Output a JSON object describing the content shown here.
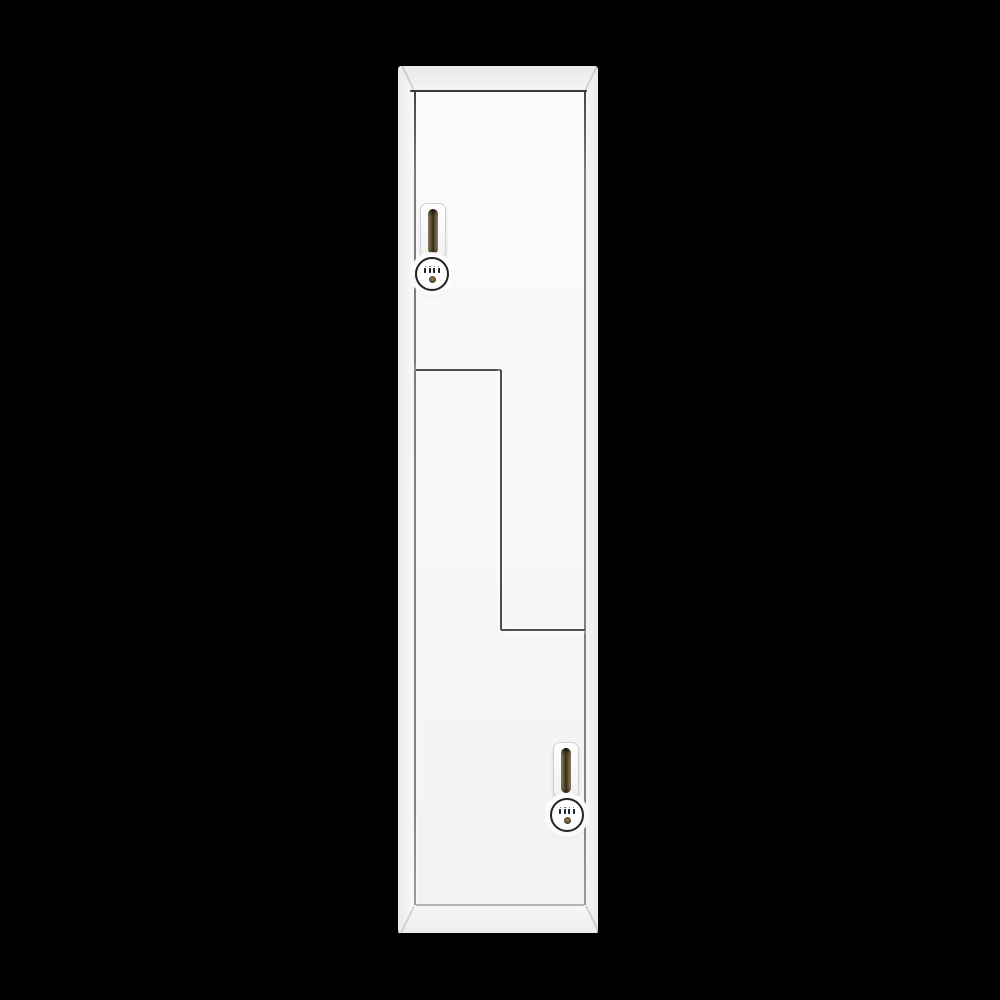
{
  "image": {
    "type": "product-photo",
    "subject": "Tall white Z-style storage locker with two Z-shaped doors, recessed pull handles and round combination locks on a black background",
    "text_content": "none"
  },
  "palette": {
    "background": "#000000",
    "cabinet_white": "#f8f8f8",
    "panel_shadow": "#e9e9e9",
    "seam_dark": "#383838",
    "seam_mid": "#4f4f4f",
    "seam_light": "#b3b3b3",
    "handle_plate": "#fdfdfd",
    "handle_slot_dark": "#332a18",
    "handle_slot_light": "#cdc2a6",
    "lock_ring": "#242424",
    "lock_face": "#ffffff",
    "dial_marks": "#1d2530",
    "keyhole_brass": "#9a7d4e"
  },
  "objects": {
    "cabinet": "locker-cabinet",
    "top_panel": "locker-top-panel",
    "base_panel": "locker-base-panel",
    "upper_door": "upper-z-door",
    "lower_door": "lower-z-door",
    "upper_handle": "upper-door-handle",
    "lower_handle": "lower-door-handle",
    "upper_lock": "upper-door-combination-lock",
    "lower_lock": "lower-door-combination-lock",
    "lock_detail": "combination-dials and keyhole-icon"
  }
}
